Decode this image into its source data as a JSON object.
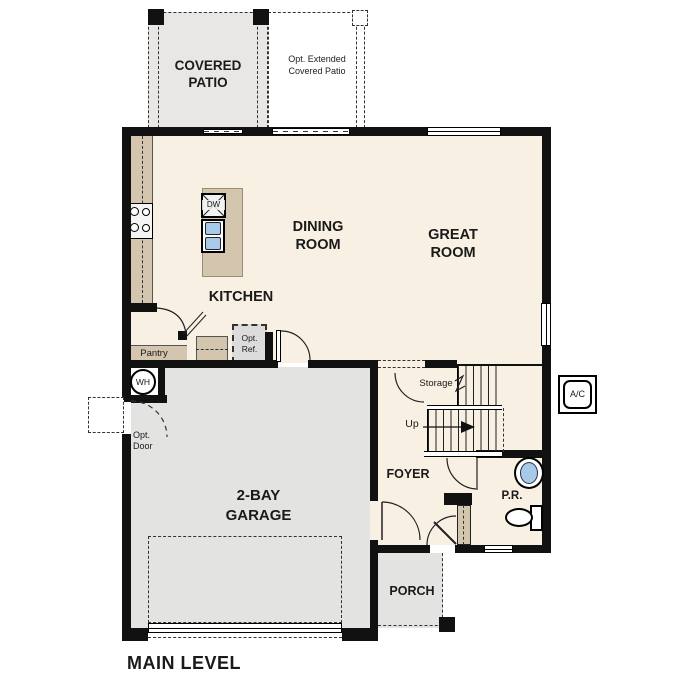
{
  "plan": {
    "title": "MAIN LEVEL",
    "rooms": {
      "covered_patio": "COVERED\nPATIO",
      "opt_extended_patio": "Opt. Extended\nCovered Patio",
      "dining_room": "DINING\nROOM",
      "great_room": "GREAT\nROOM",
      "kitchen": "KITCHEN",
      "pantry": "Pantry",
      "garage": "2-BAY\nGARAGE",
      "foyer": "FOYER",
      "powder_room": "P.R.",
      "porch": "PORCH",
      "storage": "Storage"
    },
    "labels": {
      "opt_ref": "Opt.\nRef.",
      "opt_door": "Opt.\nDoor",
      "water_heater": "WH",
      "dishwasher": "DW",
      "ac_unit": "A/C",
      "stairs_up": "Up"
    },
    "colors": {
      "floor_cream": "#f8f0e3",
      "counter_tan": "#d4c5ae",
      "concrete_gray": "#e6e5e3",
      "fixture_blue": "#a9c9e8",
      "wall_black": "#111111"
    }
  }
}
